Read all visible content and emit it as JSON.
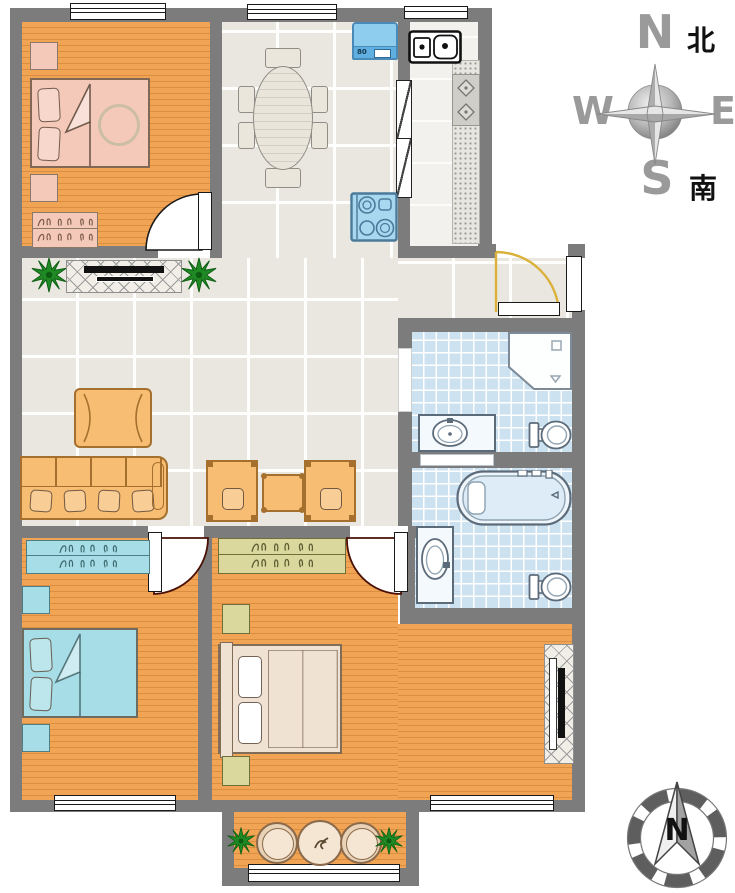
{
  "title": "apartment-floor-plan",
  "colors": {
    "wall": "#7c7c7c",
    "wood": "#f2a455",
    "tile": "#eae7e0",
    "btile": "#cde2f1",
    "pink": "#f5c9ba",
    "blue": "#a6dde6",
    "khaki": "#dbd89e",
    "cream": "#f0e2d2",
    "sofa": "#f6bd73",
    "appl": "#8fcdee",
    "plant": "#1f8a24",
    "arc": "#4a1005",
    "entry": "#d9b13b"
  },
  "compass_top": {
    "north": "N",
    "north_zh": "北",
    "west": "W",
    "east": "E",
    "south": "S",
    "south_zh": "南"
  },
  "compass_bottom": {
    "north": "N"
  },
  "kitchen": {
    "washing_machine_label": "80"
  },
  "rooms": [
    {
      "name": "bedroom-top-left",
      "floor": "wood",
      "furniture": [
        "double-bed",
        "two-nightstands",
        "dresser",
        "hinged-door",
        "window"
      ]
    },
    {
      "name": "dining-area",
      "floor": "tile",
      "furniture": [
        "oval-table",
        "six-chairs",
        "washing-machine",
        "gas-stove"
      ]
    },
    {
      "name": "kitchen",
      "floor": "tile",
      "furniture": [
        "double-sink",
        "counter",
        "two-burner-hob",
        "sliding-door",
        "window"
      ]
    },
    {
      "name": "living-room",
      "floor": "tile",
      "furniture": [
        "tv-cabinet",
        "tv",
        "two-plants",
        "coffee-table",
        "sofa",
        "two-armchairs",
        "side-table"
      ]
    },
    {
      "name": "entry-hall",
      "floor": "tile",
      "furniture": [
        "entry-door"
      ]
    },
    {
      "name": "bathroom-upper",
      "floor": "blue-tile",
      "furniture": [
        "corner-shower",
        "vanity-sink",
        "toilet"
      ]
    },
    {
      "name": "bathroom-lower",
      "floor": "blue-tile",
      "furniture": [
        "bathtub",
        "vanity-sink",
        "toilet"
      ]
    },
    {
      "name": "bedroom-bottom-left",
      "floor": "wood",
      "furniture": [
        "wardrobe",
        "double-bed",
        "two-nightstands",
        "hinged-door",
        "window"
      ]
    },
    {
      "name": "master-bedroom",
      "floor": "wood",
      "furniture": [
        "wardrobe",
        "double-bed",
        "two-nightstands",
        "tv-cabinet",
        "hinged-door",
        "window"
      ]
    },
    {
      "name": "balcony",
      "floor": "wood",
      "furniture": [
        "two-plants",
        "two-round-chairs",
        "round-table",
        "railing"
      ]
    }
  ]
}
